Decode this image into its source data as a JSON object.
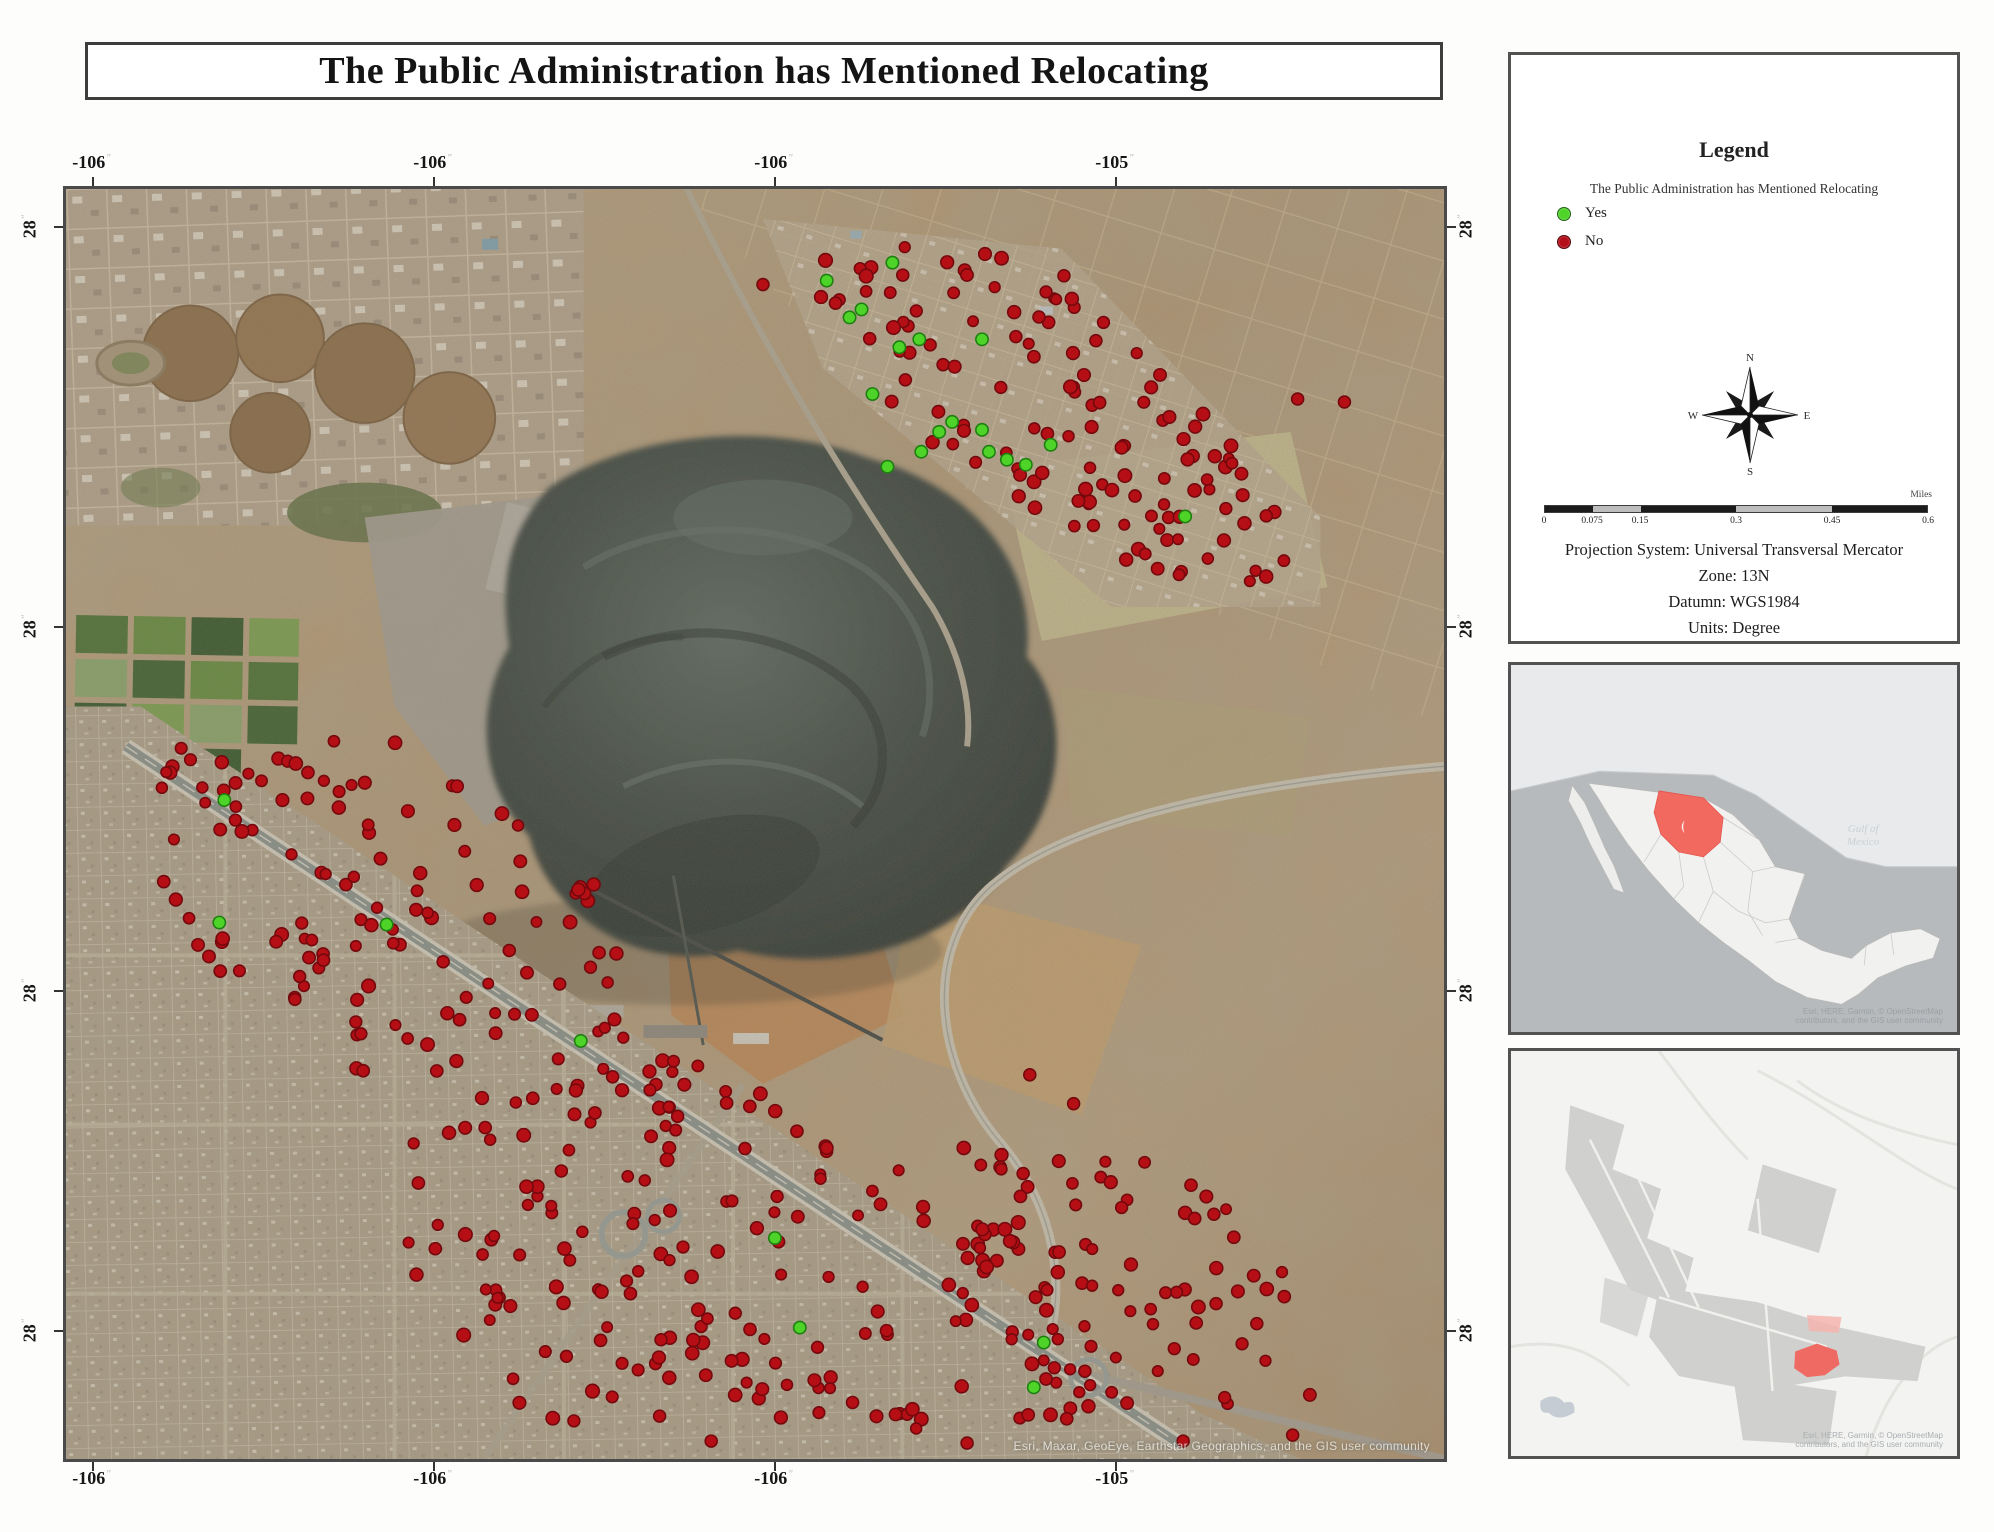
{
  "figure_title": "The Public Administration has Mentioned Relocating",
  "axes": {
    "top": [
      "-106",
      "-106",
      "-106",
      "-105"
    ],
    "bottom": [
      "-106",
      "-106",
      "-106",
      "-105"
    ],
    "left": [
      "28",
      "28",
      "28",
      "28"
    ],
    "right": [
      "28",
      "28",
      "28",
      "28"
    ],
    "tick_mark": "″"
  },
  "legend": {
    "title": "Legend",
    "subtitle": "The Public Administration has Mentioned Relocating",
    "items": [
      {
        "label": "Yes",
        "color": "#4ed428"
      },
      {
        "label": "No",
        "color": "#b50f1a"
      }
    ],
    "compass": {
      "n": "N",
      "e": "E",
      "s": "S",
      "w": "W"
    },
    "scalebar": {
      "labels": [
        "0",
        "0.075",
        "0.15",
        "0.3",
        "0.45",
        "0.6"
      ],
      "unit": "Miles",
      "colors": [
        "#1b1b1b",
        "#bdbdbd"
      ]
    },
    "projection": [
      "Projection System: Universal Transversal Mercator",
      "Zone: 13N",
      "Datumn: WGS1984",
      "Units: Degree"
    ]
  },
  "main_map": {
    "attribution": "Esri, Maxar, GeoEye, Earthstar Geographics, and the GIS user community",
    "dot_style": {
      "red_fill": "#b50f15",
      "red_stroke": "#73090d",
      "green_fill": "#4ed428",
      "green_stroke": "#1e7f10"
    },
    "red_clusters": [
      {
        "name": "northeast-colonia",
        "seed": 7,
        "count": 130,
        "polygon": [
          [
            757,
            50
          ],
          [
            995,
            68
          ],
          [
            1245,
            330
          ],
          [
            1250,
            398
          ],
          [
            1060,
            400
          ],
          [
            858,
            252
          ],
          [
            757,
            152
          ]
        ]
      },
      {
        "name": "southwest-upper",
        "seed": 11,
        "count": 130,
        "polygon": [
          [
            95,
            555
          ],
          [
            345,
            550
          ],
          [
            565,
            715
          ],
          [
            565,
            945
          ],
          [
            330,
            945
          ],
          [
            95,
            735
          ]
        ]
      },
      {
        "name": "southwest-main",
        "seed": 13,
        "count": 200,
        "polygon": [
          [
            330,
            945
          ],
          [
            565,
            845
          ],
          [
            1010,
            1060
          ],
          [
            1085,
            1248
          ],
          [
            425,
            1248
          ],
          [
            332,
            1060
          ]
        ]
      },
      {
        "name": "southeast-lobe",
        "seed": 17,
        "count": 70,
        "polygon": [
          [
            880,
            945
          ],
          [
            1160,
            990
          ],
          [
            1250,
            1105
          ],
          [
            1250,
            1235
          ],
          [
            1005,
            1230
          ],
          [
            878,
            1060
          ]
        ]
      }
    ],
    "extra_red_dots": [
      [
        1237,
        211
      ],
      [
        1284,
        214
      ],
      [
        700,
        96
      ],
      [
        648,
        1258
      ],
      [
        905,
        1260
      ],
      [
        1122,
        1258
      ],
      [
        1196,
        1140
      ],
      [
        1232,
        1252
      ],
      [
        968,
        890
      ],
      [
        1012,
        919
      ]
    ],
    "green_dots": [
      [
        830,
        74
      ],
      [
        764,
        92
      ],
      [
        799,
        121
      ],
      [
        787,
        129
      ],
      [
        857,
        151
      ],
      [
        920,
        151
      ],
      [
        837,
        159
      ],
      [
        810,
        206
      ],
      [
        890,
        234
      ],
      [
        877,
        244
      ],
      [
        920,
        242
      ],
      [
        927,
        264
      ],
      [
        945,
        272
      ],
      [
        964,
        277
      ],
      [
        989,
        257
      ],
      [
        859,
        264
      ],
      [
        825,
        279
      ],
      [
        1124,
        329
      ],
      [
        159,
        614
      ],
      [
        154,
        737
      ],
      [
        322,
        739
      ],
      [
        517,
        856
      ],
      [
        712,
        1054
      ],
      [
        737,
        1144
      ],
      [
        972,
        1204
      ],
      [
        982,
        1159
      ]
    ]
  },
  "insets": {
    "mexico": {
      "highlight_color": "#f2695f",
      "gulf_label_1": "Gulf of",
      "gulf_label_2": "Mexico",
      "attribution_1": "Esri, HERE, Garmin, © OpenStreetMap",
      "attribution_2": "contributors, and the GIS user community"
    },
    "city": {
      "highlight_color": "#ee6a62",
      "attribution_1": "Esri, HERE, Garmin, © OpenStreetMap",
      "attribution_2": "contributors, and the GIS user community"
    }
  }
}
